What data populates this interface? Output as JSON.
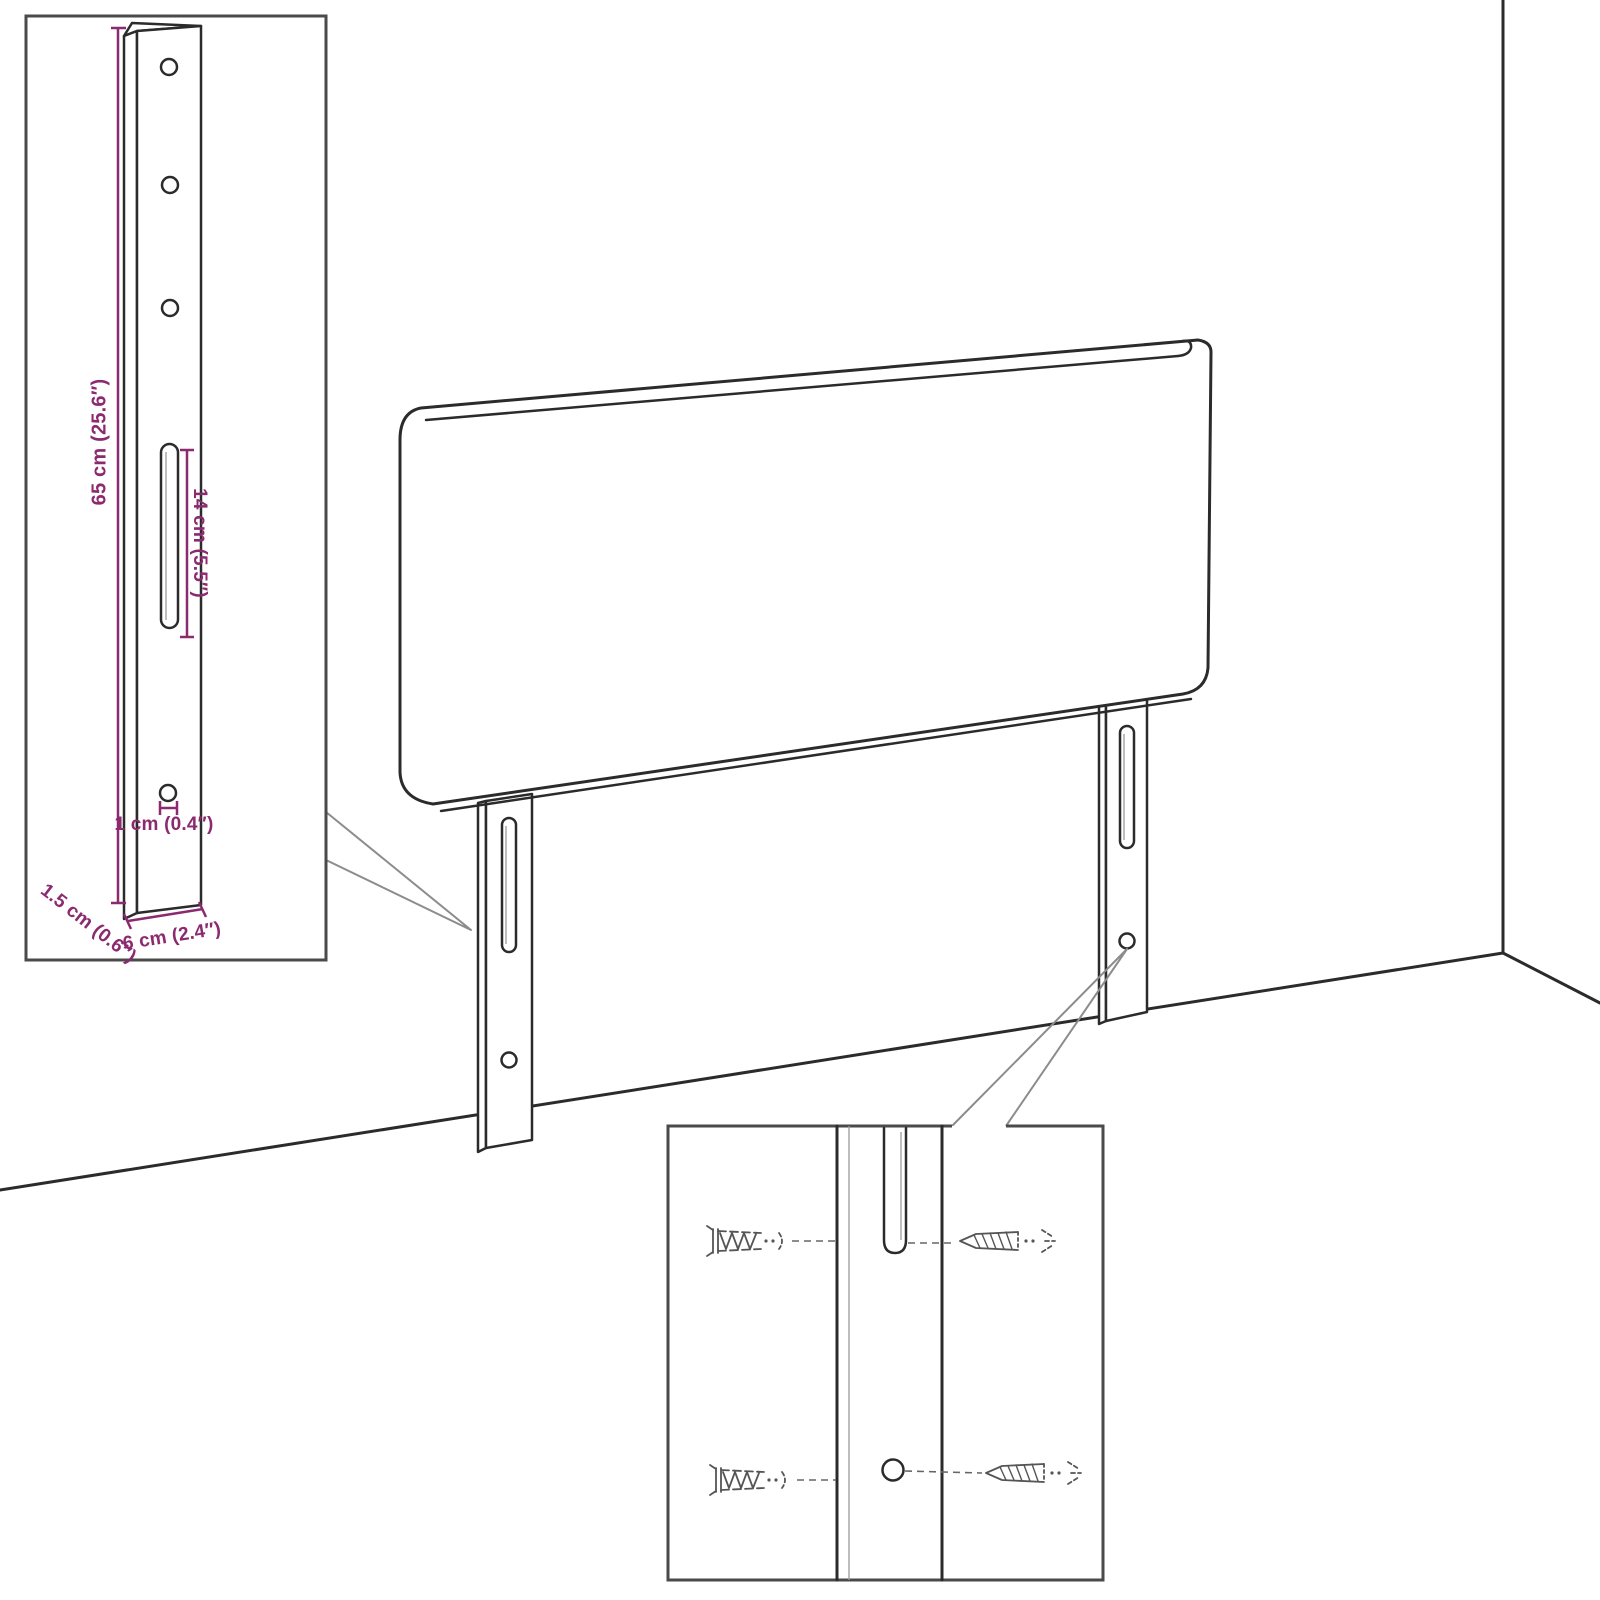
{
  "colors": {
    "dimension_text": "#8b2a6f",
    "line_art": "#2b2b2b",
    "callout": "#8c8c8c",
    "inset_border": "#4a4a4a",
    "sketch": "#555555"
  },
  "bracket_inset": {
    "labels": {
      "total_height": "65 cm (25.6″)",
      "slot_length": "14 cm (5.5″)",
      "hole_diameter": "1 cm (0.4″)",
      "depth": "1.5 cm (0.6″)",
      "width": "6 cm (2.4″)"
    }
  },
  "icons": {
    "wall_plug": "wall-plug-icon",
    "screw": "screw-icon"
  }
}
